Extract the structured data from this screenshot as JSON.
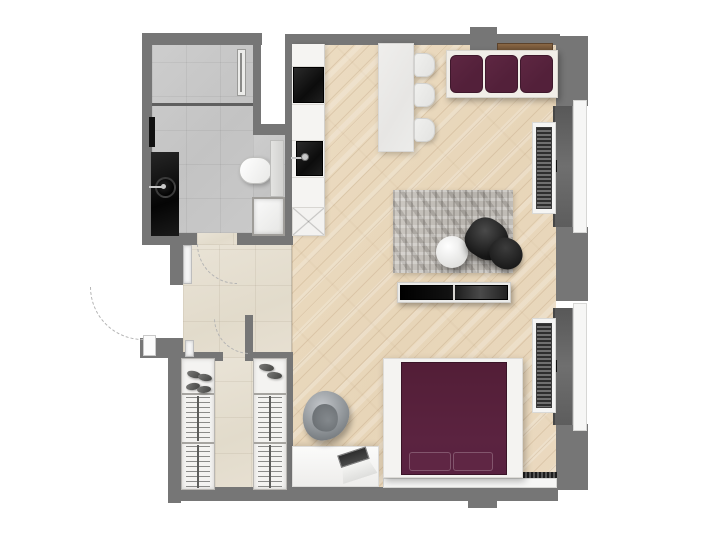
{
  "meta": {
    "title": "Studio apartment floor plan — top-down 3D render",
    "view": "top-down orthographic",
    "visible_text": "none"
  },
  "colors": {
    "page": "#ffffff",
    "wall": "#767676",
    "wood_floor": "#e9d8bd",
    "hall_tile": "#e5dfd0",
    "bath_tile": "#c7c7c7",
    "plum": "#53203a",
    "bed_plum": "#571f38",
    "console_wood": "#7c5b3b",
    "rug_gray": "#c0bcb6",
    "black_furniture": "#151515",
    "fixture_white": "#f4f3f1"
  },
  "rooms": [
    {
      "id": "bathroom",
      "label": "Bathroom",
      "floor": "gray tile",
      "fixtures": [
        "shower area with linear drain",
        "glass shower partition",
        "wall mirror",
        "black vanity with round basin and faucet",
        "wall-hung toilet with cistern panel",
        "washing machine"
      ]
    },
    {
      "id": "entry-hall",
      "label": "Entry hall",
      "floor": "beige tile",
      "fixtures": [
        "entry door swing arc (opens outward)",
        "bathroom door swing arc",
        "corridor door swing arc",
        "door jambs"
      ]
    },
    {
      "id": "wardrobe-corridor",
      "label": "Walk-in wardrobe corridor",
      "floor": "beige tile",
      "fixtures": [
        "left wardrobe: shoe shelf + 2 hanging rails",
        "right wardrobe: shoe shelf + 2 hanging rails",
        "shoes"
      ]
    },
    {
      "id": "kitchen",
      "label": "Kitchenette run",
      "floor": "wood",
      "fixtures": [
        "white counter run",
        "black cooktop",
        "black sink with faucet",
        "cabinet with X front (dishwasher)"
      ]
    },
    {
      "id": "living-sleeping",
      "label": "Living / sleeping room",
      "floor": "wood planks laid diagonally",
      "fixtures": [
        "dining table",
        "3 dining chairs",
        "3-seat plum sofa on white frame",
        "wood console shelf behind sofa",
        "gray textured rug",
        "round white coffee table",
        "black swivel armchair with ottoman",
        "black TV sideboard",
        "double bed with plum bedding and 2 pillows",
        "white desk with open laptop",
        "gray beanbag pouf"
      ]
    }
  ],
  "windows": [
    {
      "id": "window-upper-right",
      "parts": [
        "dark glazing",
        "black handle",
        "white outer sill",
        "slatted radiator with white surround"
      ]
    },
    {
      "id": "window-lower-right",
      "parts": [
        "dark glazing",
        "black handle",
        "white outer sill",
        "slatted radiator with white surround"
      ]
    }
  ],
  "structure": {
    "walls": "medium gray poché",
    "shaft": "white void between bathroom and kitchen wall (top)",
    "bottom_pier": "small exterior pier on bottom wall",
    "door_arcs_style": "dashed light gray quarter circles"
  }
}
